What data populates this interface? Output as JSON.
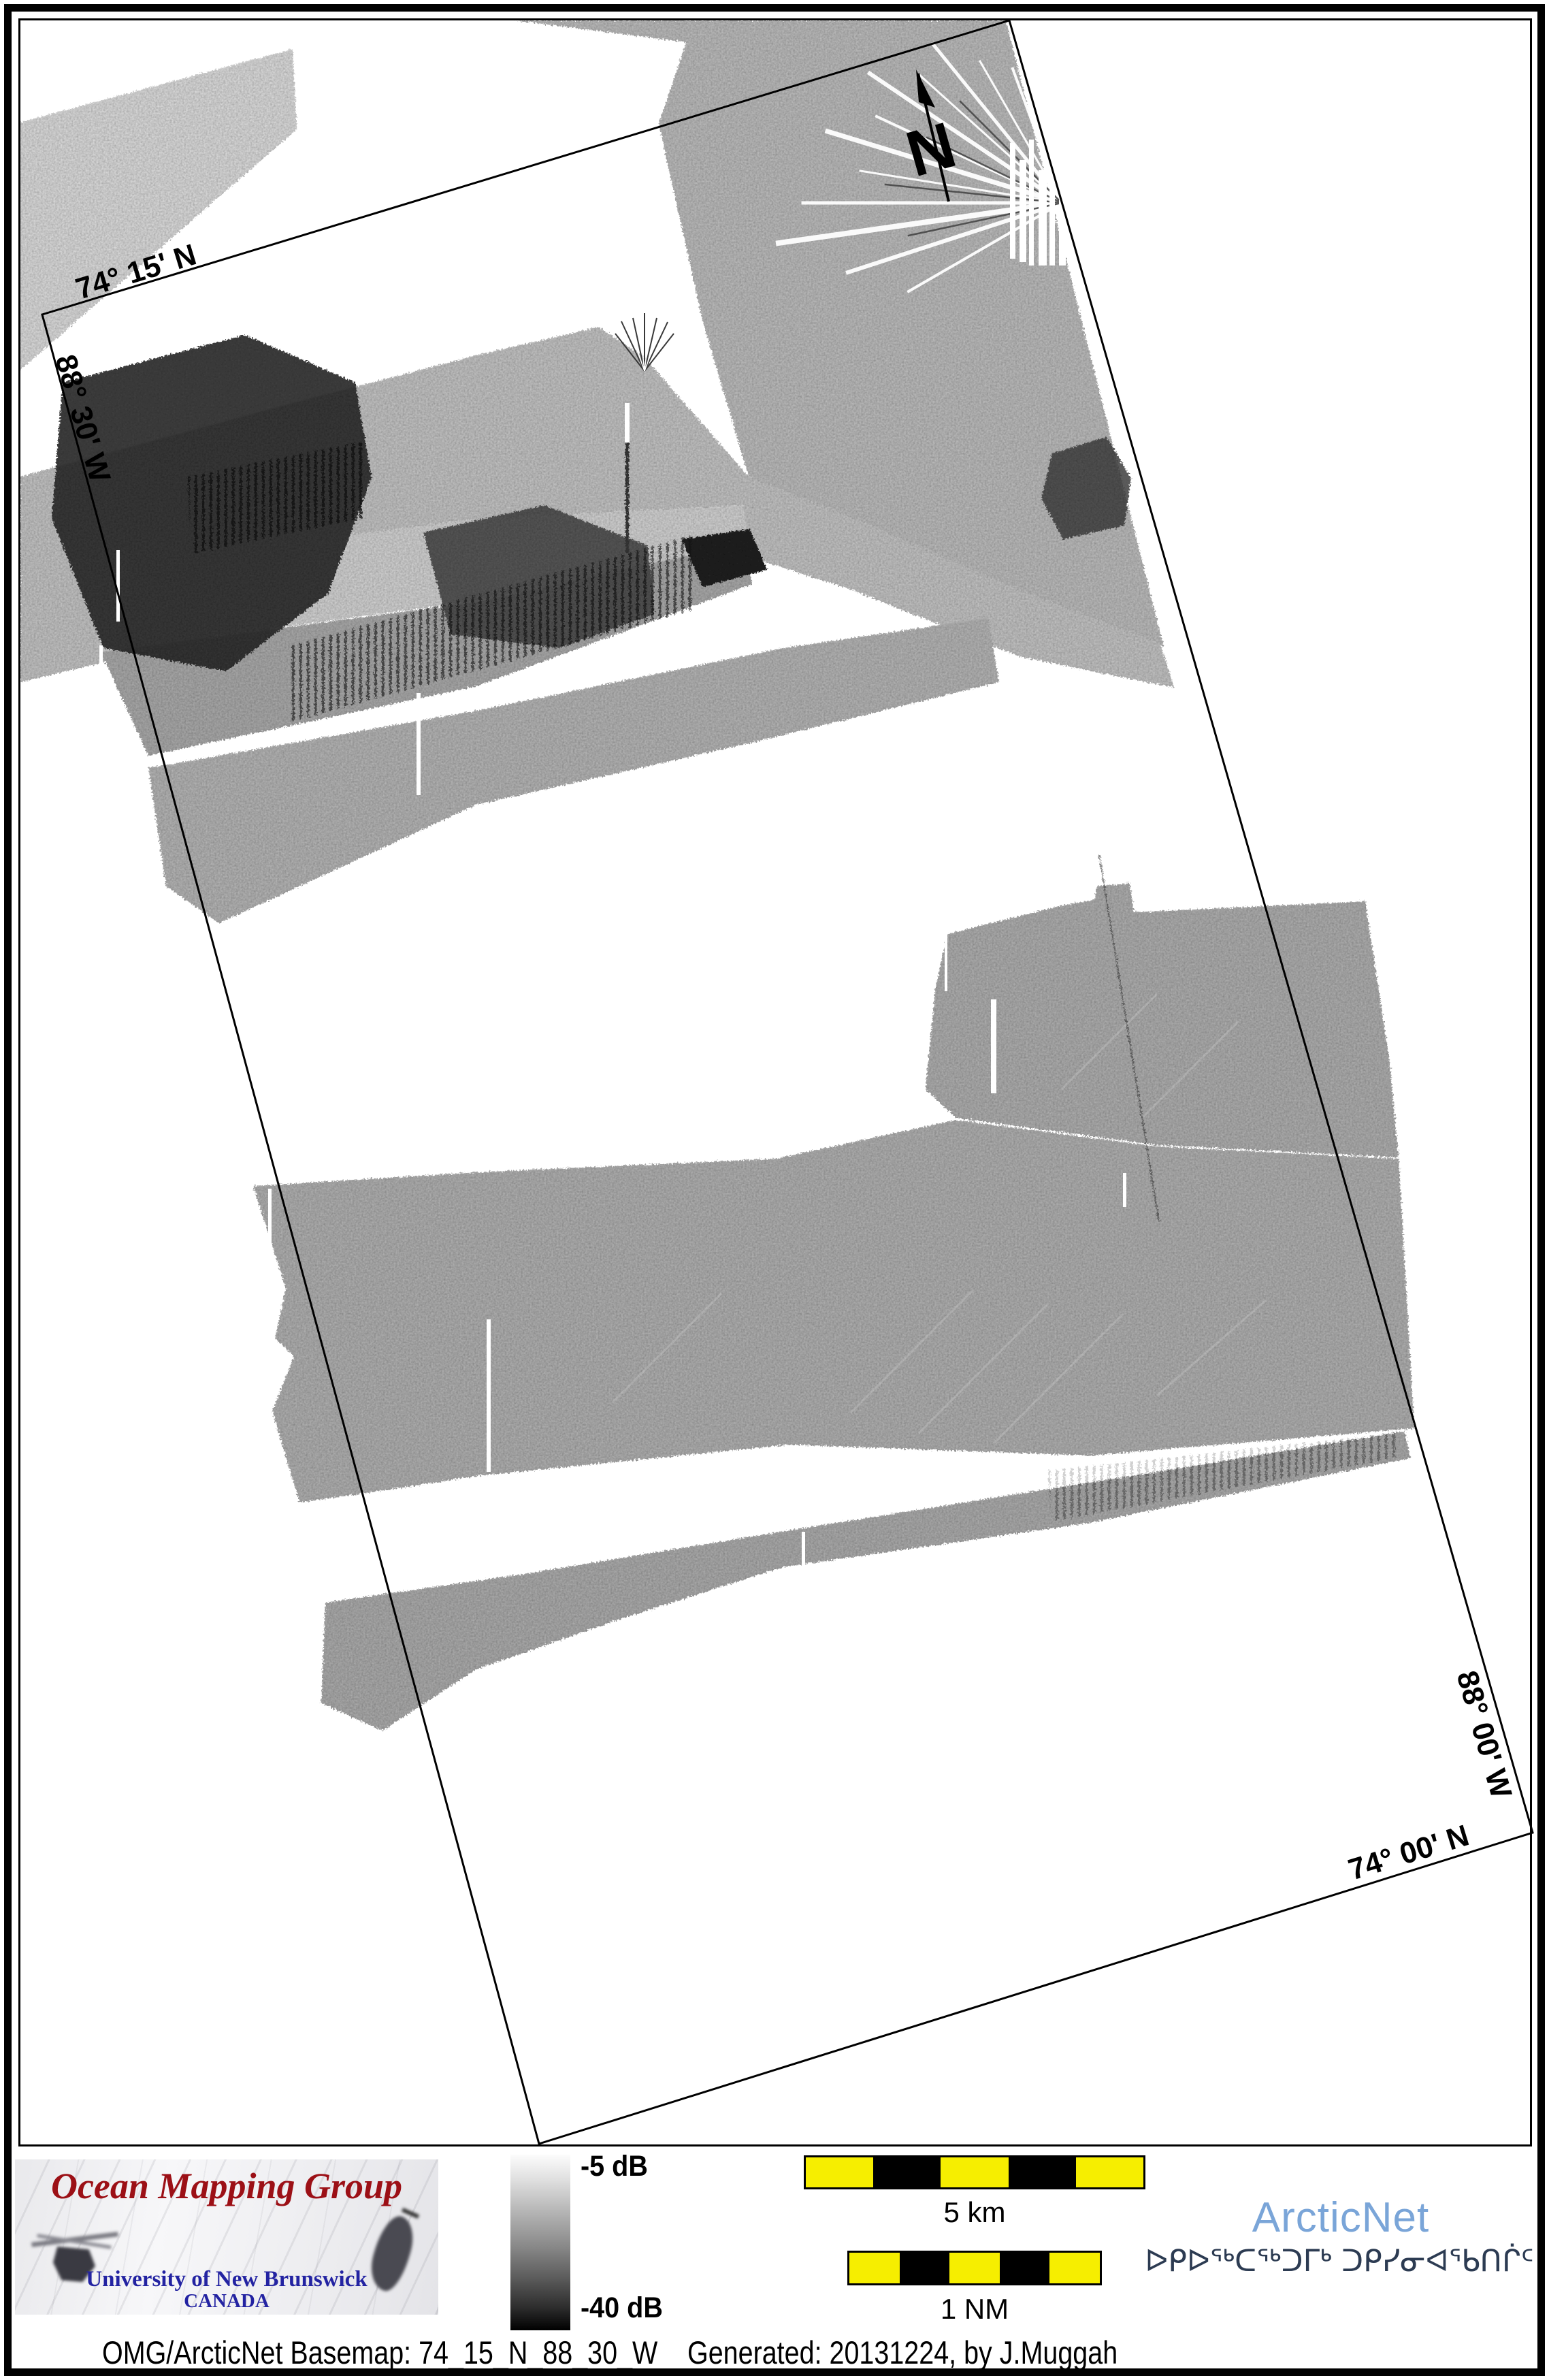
{
  "map": {
    "north_label": "N",
    "labels": {
      "top_left_lat": "74° 15' N",
      "left_lon": "88° 30' W",
      "right_lon": "88° 00' W",
      "bottom_right_lat": "74° 00' N"
    }
  },
  "legend": {
    "omg": {
      "title": "Ocean Mapping Group",
      "university": "University of New Brunswick",
      "country": "CANADA"
    },
    "colorbar": {
      "top_label": "-5 dB",
      "bottom_label": "-40 dB"
    },
    "scalebars": [
      {
        "label": "5 km",
        "segments": 5
      },
      {
        "label": "1 NM",
        "segments": 5
      }
    ],
    "arcticnet": {
      "name": "ArcticNet",
      "inuktitut": "ᐅᑭᐅᖅᑕᖅᑐᒥᒃ ᑐᑭᓯᓂᐊᖃᑎᒌᑦ"
    },
    "caption": {
      "left": "OMG/ArcticNet Basemap: 74_15_N_88_30_W",
      "right": "Generated: 20131224, by J.Muggah"
    }
  },
  "colors": {
    "omg_red": "#9c1016",
    "unb_navy": "#2323a2",
    "arcticnet_blue": "#7aa5d8",
    "syllabics_navy": "#2c3b52",
    "scalebar_yellow": "#f6ee00",
    "swath_gray": "#9e9e9e"
  }
}
